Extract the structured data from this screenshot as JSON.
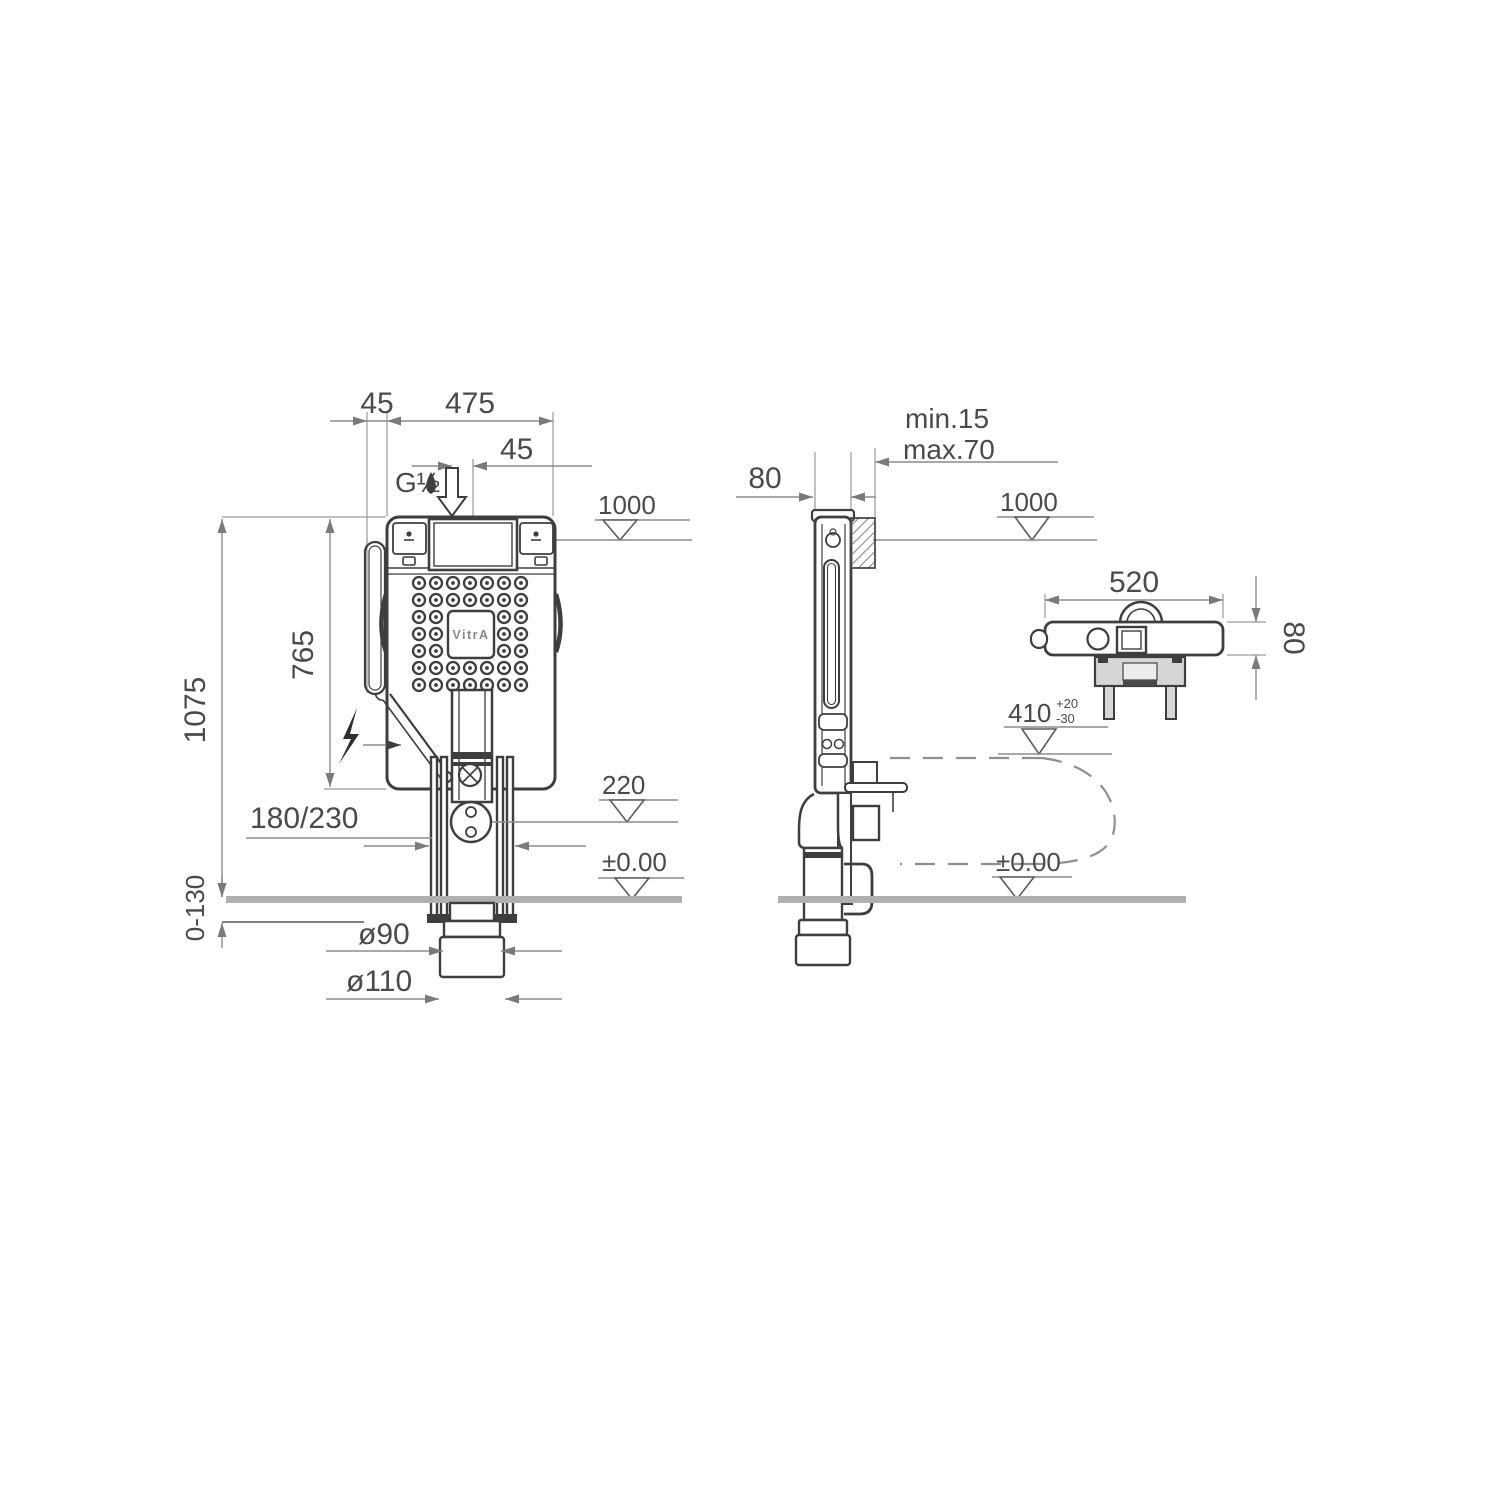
{
  "front_view": {
    "dim_45_left": "45",
    "dim_475": "475",
    "dim_45_supply": "45",
    "supply_thread": "G½",
    "level_1000": "1000",
    "dim_765": "765",
    "dim_1075": "1075",
    "dim_180_230": "180/230",
    "level_220": "220",
    "level_floor": "±0.00",
    "dim_0_130": "0-130",
    "dia_90": "ø90",
    "dia_110": "ø110",
    "brand": "VitrA"
  },
  "side_view": {
    "dim_80": "80",
    "wall_min": "min.15",
    "wall_max": "max.70",
    "level_1000": "1000",
    "level_410": "410",
    "tol_plus": "+20",
    "tol_minus": "-30",
    "level_floor": "±0.00"
  },
  "top_view": {
    "dim_520": "520",
    "dim_80": "80"
  }
}
